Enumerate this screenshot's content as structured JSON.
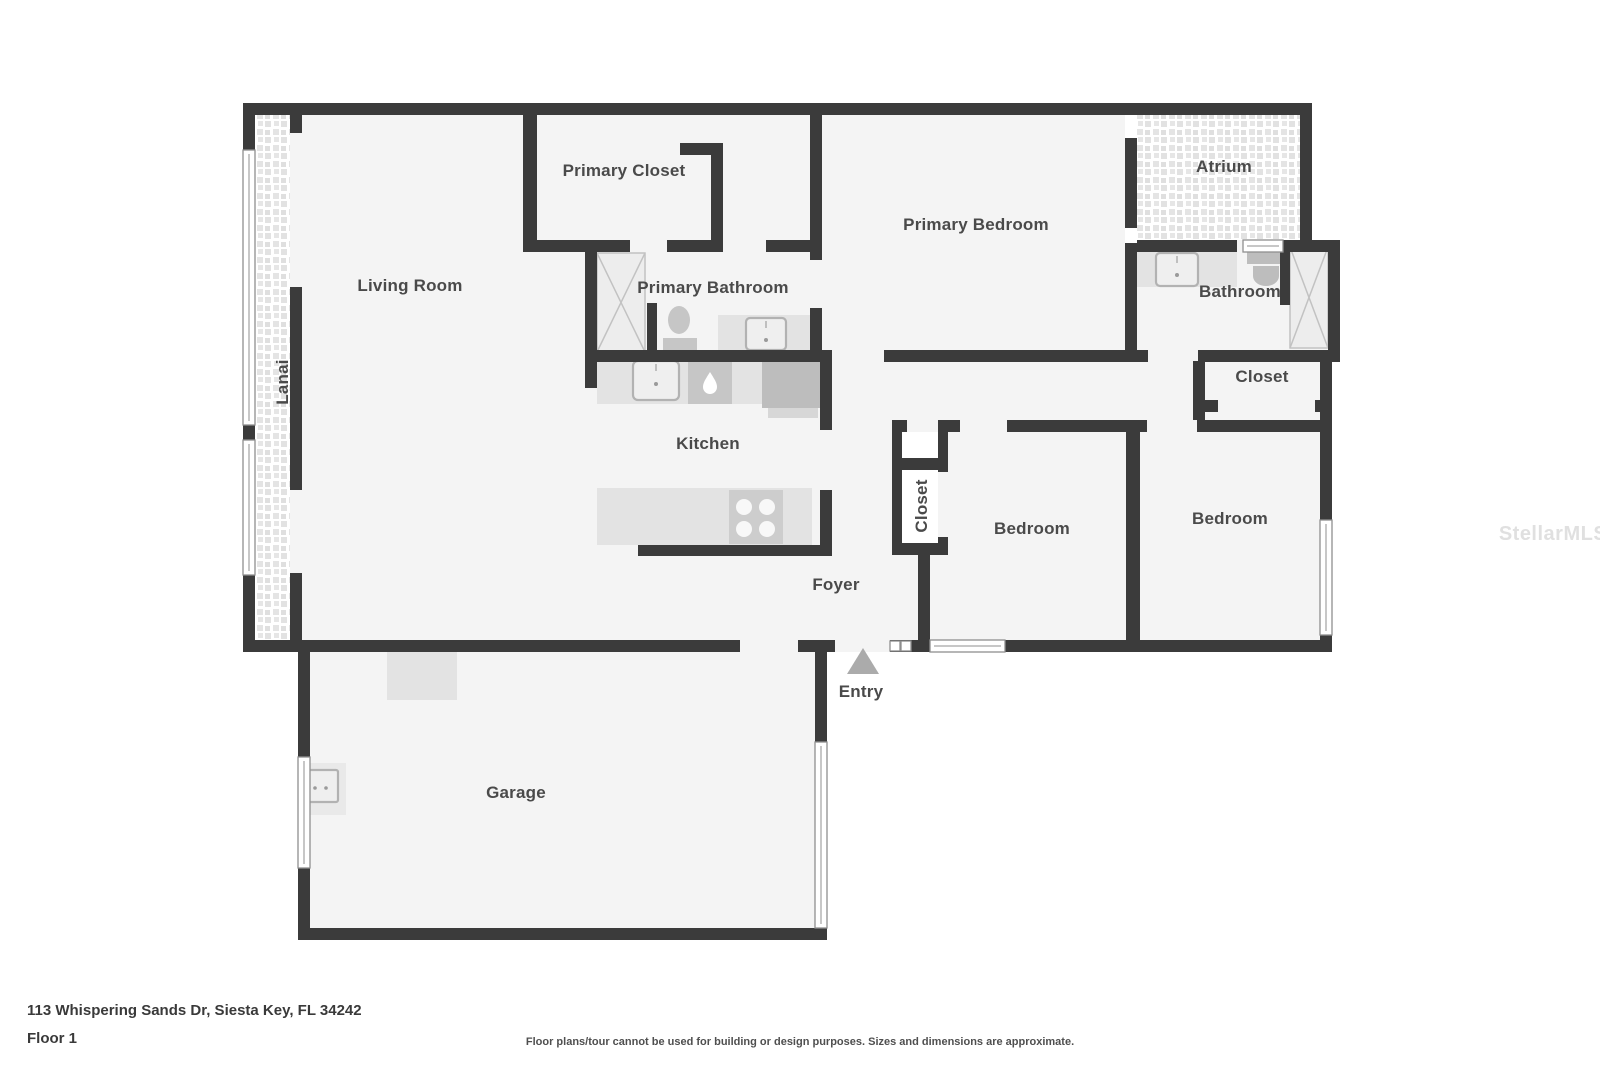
{
  "floor_plan": {
    "watermark": "StellarMLS",
    "entry_label": "Entry",
    "rooms": {
      "living_room": "Living Room",
      "lanai": "Lanai",
      "primary_closet": "Primary Closet",
      "primary_bathroom": "Primary Bathroom",
      "primary_bedroom": "Primary Bedroom",
      "atrium": "Atrium",
      "bathroom": "Bathroom",
      "closet_hall": "Closet",
      "closet_bedroom": "Closet",
      "kitchen": "Kitchen",
      "bedroom_middle": "Bedroom",
      "bedroom_right": "Bedroom",
      "foyer": "Foyer",
      "garage": "Garage"
    },
    "colors": {
      "wall": "#3b3b3b",
      "floor": "#f4f4f4",
      "fixture": "#c6c6c6",
      "label": "#4a4a4a",
      "watermark": "#e0e0e0"
    }
  },
  "footer": {
    "address": "113 Whispering Sands Dr, Siesta Key, FL 34242",
    "floor_label": "Floor 1",
    "disclaimer": "Floor plans/tour cannot be used for building or design purposes. Sizes and dimensions are approximate."
  }
}
